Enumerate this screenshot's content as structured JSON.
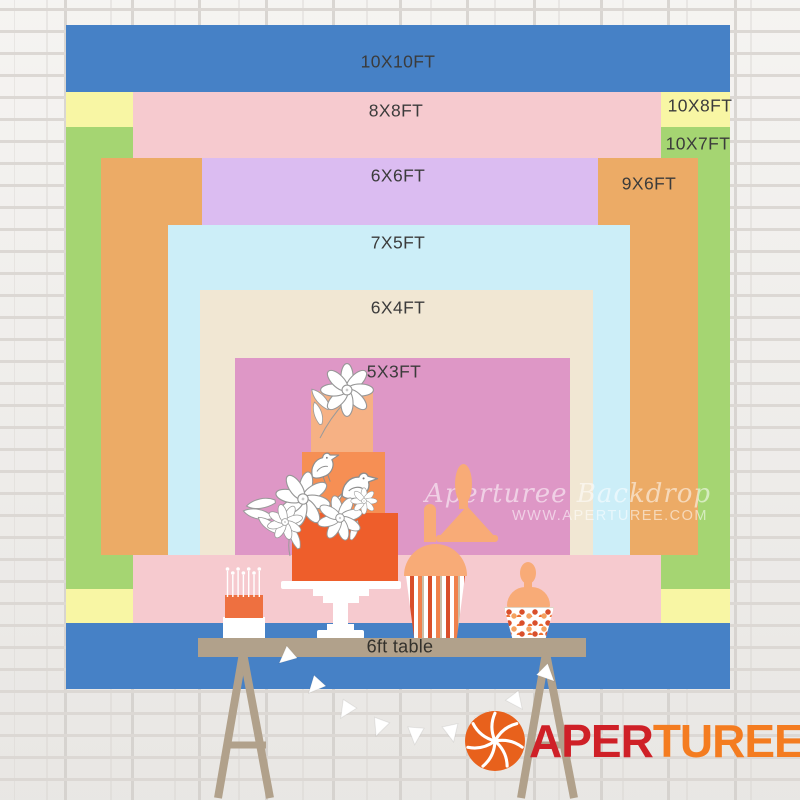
{
  "title": "Backdrop size comparison chart",
  "sizes": [
    {
      "label": "10X10FT",
      "color": "#4681c6",
      "x": 66,
      "y": 25,
      "w": 664,
      "h": 664,
      "lx": 398,
      "ly": 62
    },
    {
      "label": "10X8FT",
      "color": "#f8f6a4",
      "x": 66,
      "y": 92,
      "w": 664,
      "h": 531,
      "lx": 700,
      "ly": 106
    },
    {
      "label": "10X7FT",
      "color": "#a5d572",
      "x": 66,
      "y": 127,
      "w": 664,
      "h": 462,
      "lx": 698,
      "ly": 144
    },
    {
      "label": "8X8FT",
      "color": "#f6cacf",
      "x": 133,
      "y": 92,
      "w": 528,
      "h": 531,
      "lx": 396,
      "ly": 111
    },
    {
      "label": "9X6FT",
      "color": "#ecab66",
      "x": 101,
      "y": 158,
      "w": 597,
      "h": 397,
      "lx": 649,
      "ly": 184
    },
    {
      "label": "6X6FT",
      "color": "#dbbcf1",
      "x": 202,
      "y": 158,
      "w": 396,
      "h": 396,
      "lx": 398,
      "ly": 176
    },
    {
      "label": "7X5FT",
      "color": "#cceef8",
      "x": 168,
      "y": 225,
      "w": 462,
      "h": 330,
      "lx": 398,
      "ly": 243
    },
    {
      "label": "6X4FT",
      "color": "#f1e7d3",
      "x": 200,
      "y": 290,
      "w": 393,
      "h": 265,
      "lx": 398,
      "ly": 308
    },
    {
      "label": "5X3FT",
      "color": "#de97c6",
      "x": 235,
      "y": 358,
      "w": 335,
      "h": 197,
      "lx": 394,
      "ly": 372
    }
  ],
  "table": {
    "label": "6ft table"
  },
  "watermark": {
    "line1": "Aperturee Backdrop",
    "line2": "WWW.APERTUREE.COM"
  },
  "logo": {
    "icon": "aperture-icon",
    "part1": "APER",
    "part2": "TUREE"
  },
  "palette": {
    "wall": "#f2f0ed",
    "mortar": "#dcd8d4",
    "wood": "#b1a18b",
    "cakeTop": "#f6b184",
    "cakeMid": "#f68f54",
    "cakeBottom": "#ee5e2b",
    "miniCake": "#ee7040",
    "peach": "#f8ab77",
    "stripeRed": "#d94f2b",
    "stripeOrange": "#f0814c",
    "labelText": "#3b3b3b",
    "logoRed": "#cf2027",
    "logoOrange": "#f47c20",
    "watermark": "rgba(255,255,255,0.55)"
  }
}
